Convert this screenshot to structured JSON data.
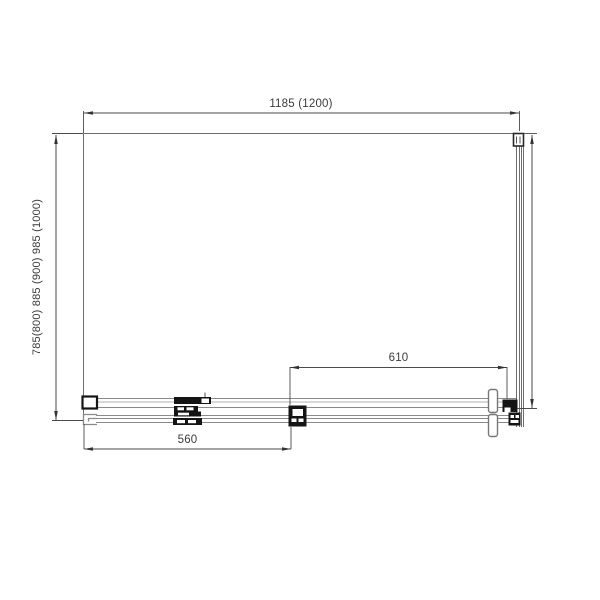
{
  "dimensions": {
    "top_width": "1185 (1200)",
    "left_depth": "785(800) 885 (900) 985 (1000)",
    "door_opening": "610",
    "door_overlap": "560"
  },
  "colors": {
    "background": "#ffffff",
    "outline_line": "#6e6e6e",
    "track_line": "#8a8a8a",
    "dimension_line": "#4a4a4a",
    "hardware_fill": "#141414",
    "text": "#3b3b3b"
  }
}
